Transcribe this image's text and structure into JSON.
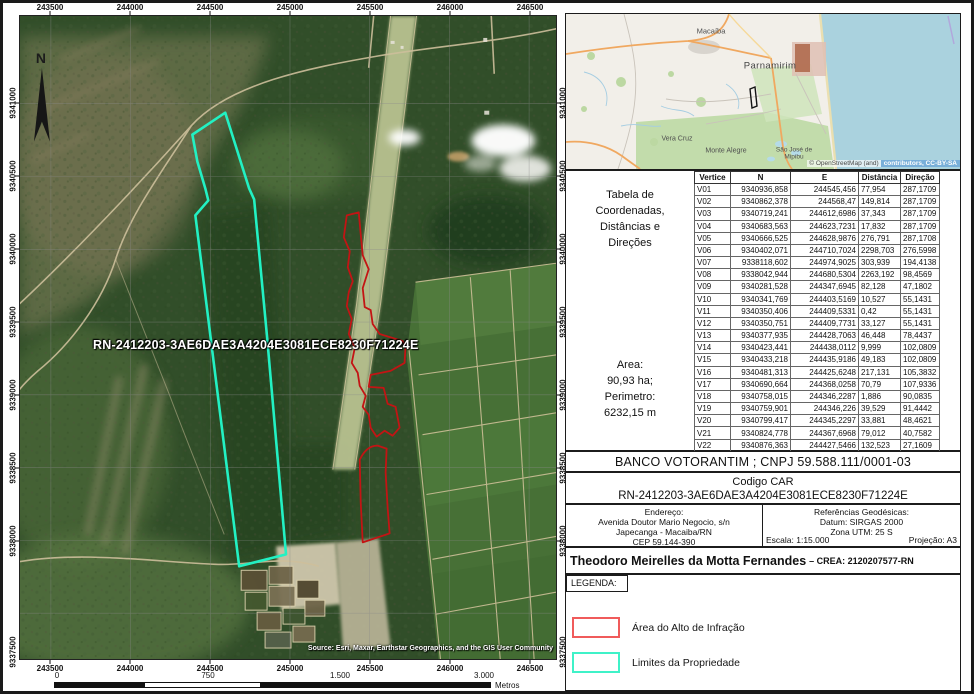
{
  "map": {
    "north_label": "N",
    "label_overlay": "RN-2412203-3AE6DAE3A4204E3081ECE8230F71224E",
    "attribution": "Source: Esri, Maxar, Earthstar Geographics, and the GIS User Community",
    "x_ticks": [
      "243500",
      "244000",
      "244500",
      "245000",
      "245500",
      "246000",
      "246500"
    ],
    "y_ticks": [
      "9341000",
      "9340500",
      "9340000",
      "9339500",
      "9339000",
      "9338500",
      "9338000"
    ],
    "y_tick_corner": "9337500",
    "scalebar": {
      "labels": [
        "0",
        "750",
        "1.500",
        "3.000"
      ],
      "unit": "Metros"
    },
    "colors": {
      "property": "#22F1C3",
      "infraction": "#C31414"
    }
  },
  "inset": {
    "places": [
      "Macaíba",
      "Parnamirim",
      "Vera Cruz",
      "Monte Alegre",
      "São José de Mipibu"
    ],
    "attribution_left": "© OpenStreetMap (and)",
    "attribution_right": "contributors, CC-BY-SA"
  },
  "table": {
    "caption_lines": [
      "Tabela de",
      "Coordenadas,",
      "Distâncias e",
      "Direções"
    ],
    "area_lines": [
      "Area:",
      "90,93 ha;",
      "Perimetro:",
      "6232,15 m"
    ],
    "headers": [
      "Vertice",
      "N",
      "E",
      "Distância",
      "Direção"
    ],
    "rows": [
      [
        "V01",
        "9340936,858",
        "244545,456",
        "77,954",
        "287,1709"
      ],
      [
        "V02",
        "9340862,378",
        "244568,47",
        "149,814",
        "287,1709"
      ],
      [
        "V03",
        "9340719,241",
        "244612,6986",
        "37,343",
        "287,1709"
      ],
      [
        "V04",
        "9340683,563",
        "244623,7231",
        "17,832",
        "287,1709"
      ],
      [
        "V05",
        "9340666,525",
        "244628,9876",
        "276,791",
        "287,1708"
      ],
      [
        "V06",
        "9340402,071",
        "244710,7024",
        "2298,703",
        "276,5998"
      ],
      [
        "V07",
        "9338118,602",
        "244974,9025",
        "303,939",
        "194,4138"
      ],
      [
        "V08",
        "9338042,944",
        "244680,5304",
        "2263,192",
        "98,4569"
      ],
      [
        "V09",
        "9340281,528",
        "244347,6945",
        "82,128",
        "47,1802"
      ],
      [
        "V10",
        "9340341,769",
        "244403,5169",
        "10,527",
        "55,1431"
      ],
      [
        "V11",
        "9340350,406",
        "244409,5331",
        "0,42",
        "55,1431"
      ],
      [
        "V12",
        "9340350,751",
        "244409,7731",
        "33,127",
        "55,1431"
      ],
      [
        "V13",
        "9340377,935",
        "244428,7063",
        "46,448",
        "78,4437"
      ],
      [
        "V14",
        "9340423,441",
        "244438,0112",
        "9,999",
        "102,0809"
      ],
      [
        "V15",
        "9340433,218",
        "244435,9186",
        "49,183",
        "102,0809"
      ],
      [
        "V16",
        "9340481,313",
        "244425,6248",
        "217,131",
        "105,3832"
      ],
      [
        "V17",
        "9340690,664",
        "244368,0258",
        "70,79",
        "107,9336"
      ],
      [
        "V18",
        "9340758,015",
        "244346,2287",
        "1,886",
        "90,0835"
      ],
      [
        "V19",
        "9340759,901",
        "244346,226",
        "39,529",
        "91,4442"
      ],
      [
        "V20",
        "9340799,417",
        "244345,2297",
        "33,881",
        "48,4621"
      ],
      [
        "V21",
        "9340824,778",
        "244367,6968",
        "79,012",
        "40,7582"
      ],
      [
        "V22",
        "9340876,363",
        "244427,5466",
        "132,523",
        "27,1609"
      ]
    ]
  },
  "owner": "BANCO VOTORANTIM ; CNPJ 59.588.111/0001-03",
  "car": {
    "title": "Codigo CAR",
    "code": "RN-2412203-3AE6DAE3A4204E3081ECE8230F71224E"
  },
  "address": {
    "title": "Endereço:",
    "lines": [
      "Avenida Doutor Mario Negocio, s/n",
      "Japecanga - Macaiba/RN",
      "CEP 59.144-390"
    ]
  },
  "geo": {
    "title": "Referências Geodésicas:",
    "datum": "Datum: SIRGAS 2000",
    "zone": "Zona UTM: 25 S",
    "scale": "Escala: 1:15.000",
    "projection": "Projeção: A3"
  },
  "responsible": {
    "name": "Theodoro Meirelles da Motta Fernandes",
    "crea": "– CREA: 2120207577-RN"
  },
  "legend": {
    "title": "LEGENDA:",
    "items": [
      {
        "label": "Área do Alto de Infração",
        "color": "#F05B5B"
      },
      {
        "label": "Limites da Propriedade",
        "color": "#3FF2C8"
      }
    ]
  }
}
